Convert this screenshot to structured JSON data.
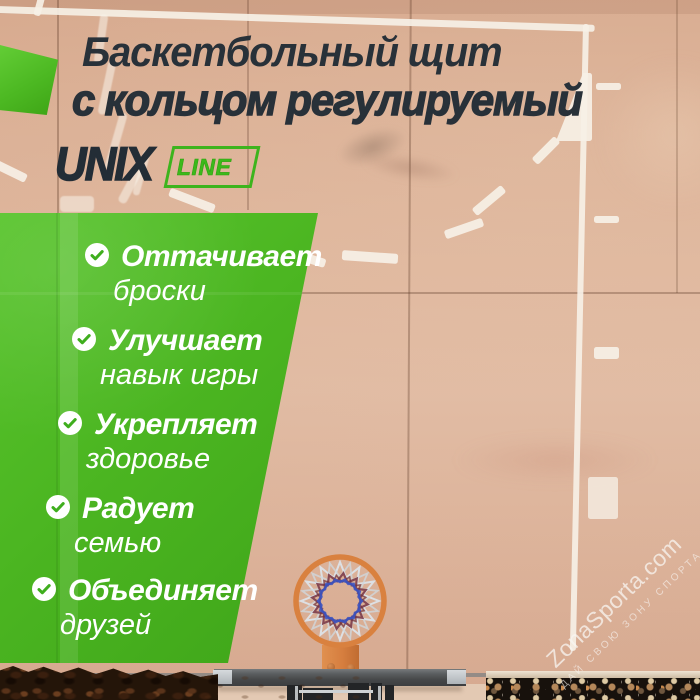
{
  "title": {
    "line1": "Баскетбольный щит",
    "line2": "с кольцом регулируемый"
  },
  "brand": {
    "name": "UNIX",
    "badge": "LINE"
  },
  "features": [
    {
      "label": "Оттачивает",
      "detail": "броски"
    },
    {
      "label": "Улучшает",
      "detail": "навык игры"
    },
    {
      "label": "Укрепляет",
      "detail": "здоровье"
    },
    {
      "label": "Радует",
      "detail": "семью"
    },
    {
      "label": "Объединяет",
      "detail": "друзей"
    }
  ],
  "watermark": {
    "site": "ZonaSporta.com",
    "slogan": "ДАЙ СВОЮ ЗОНУ СПОРТА"
  },
  "colors": {
    "accent_green": "#49B41F",
    "accent_green_light": "#5CC62E",
    "badge_green": "#3DB41D",
    "title_text": "#283139",
    "feature_text": "#FFFFFF",
    "hoop_orange": "#D9813F",
    "court_tan": "#DCB29A",
    "backboard_gray": "#46484A"
  }
}
